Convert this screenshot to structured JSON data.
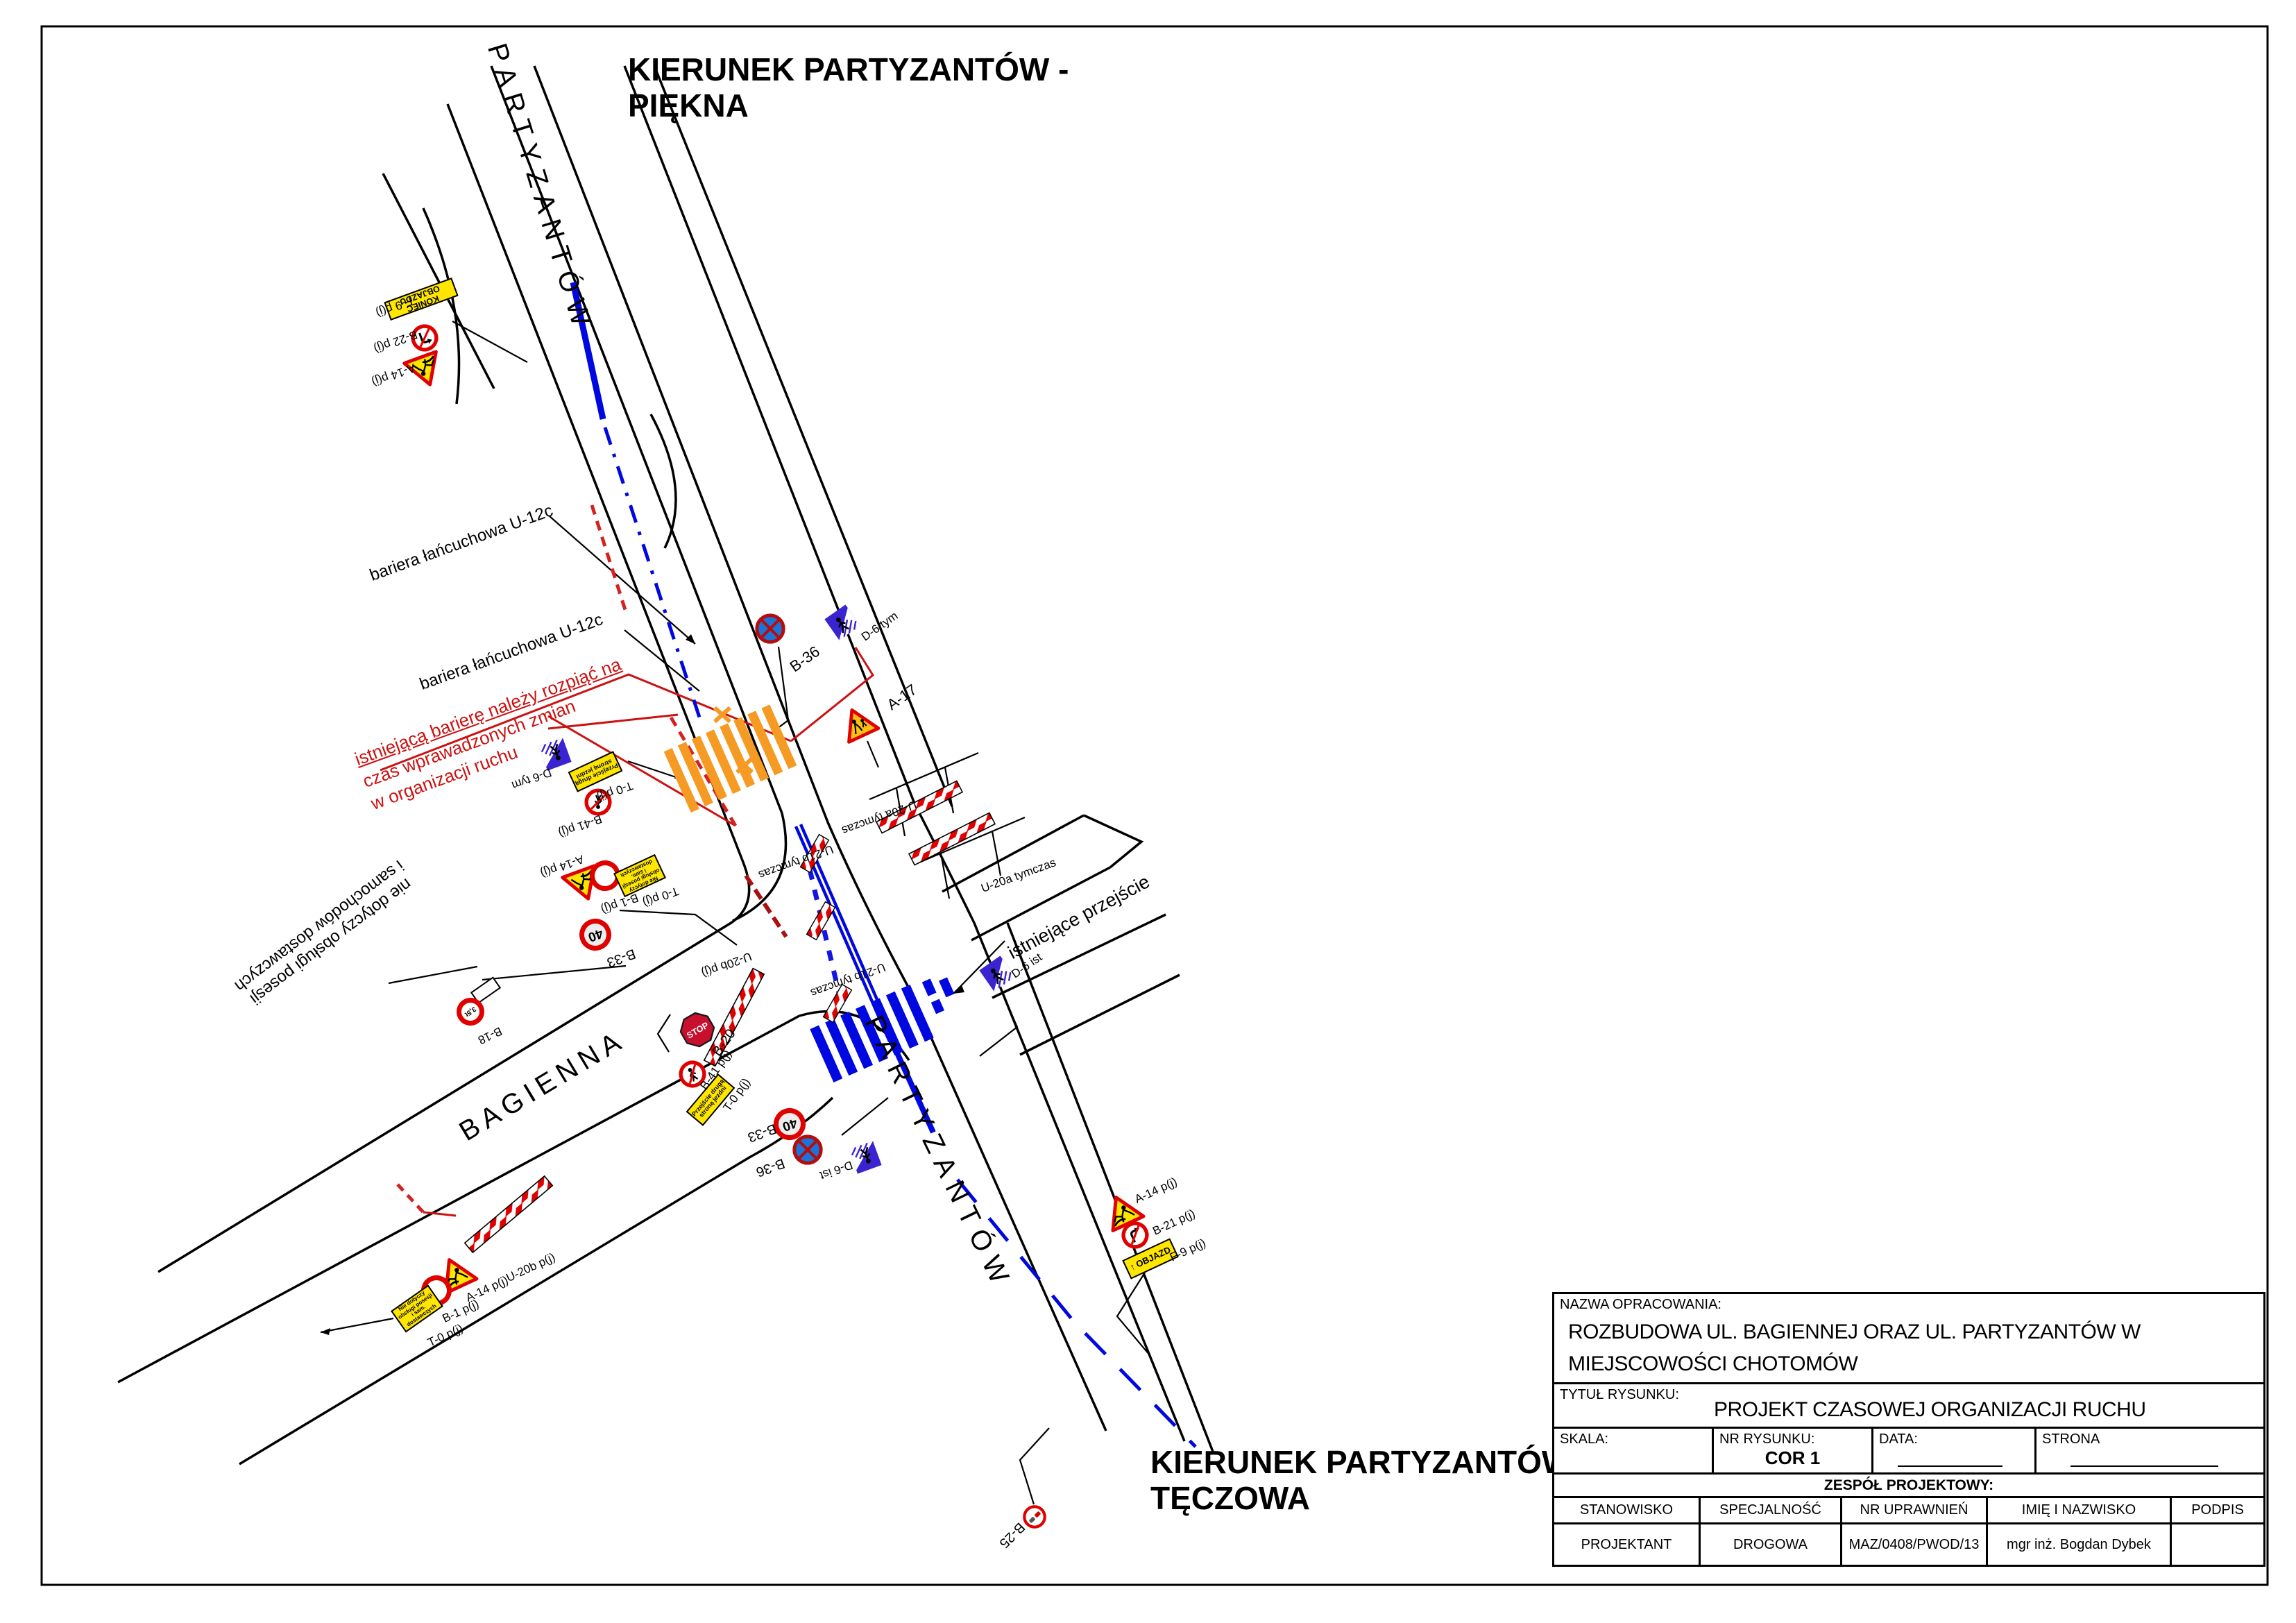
{
  "headings": {
    "top1": "KIERUNEK PARTYZANTÓW -",
    "top2": "PIĘKNA",
    "bottom1": "KIERUNEK PARTYZANTÓW -",
    "bottom2": "TĘCZOWA"
  },
  "streets": {
    "partyzantow": "PARTYZANTÓW",
    "bagienna": "BAGIENNA"
  },
  "notes": {
    "bariera": "bariera łańcuchowa U-12c",
    "red1": "istniejącą barierę należy rozpiąć na",
    "red2": "czas wprawadzonych zmian",
    "red3": "w organizacji ruchu",
    "nd1": "nie dotyczy obsługi posesji",
    "nd2": "i samochodów dostawczych",
    "existing_crossing": "istniejące przejście",
    "u20a": "U-20a tymczas",
    "u21b": "U-21b tymczas",
    "u20b": "U-20b p(j)"
  },
  "labels": {
    "f9": "F-9 p(j)",
    "b22": "B-22 p(j)",
    "a14": "A-14 p(j)",
    "b36": "B-36",
    "d6_tym": "D-6 tym",
    "d6_ist": "D-6 ist",
    "a17": "A-17",
    "t0": "T-0 p(j)",
    "b41": "B-41 p(j)",
    "b1": "B-1 p(j)",
    "b33": "B-33",
    "b20": "B-20",
    "b21": "B-21 p(j)",
    "b25": "B-25",
    "b18": "B-18"
  },
  "sign_text": {
    "stop": "STOP",
    "speed40": "40",
    "weight": "3,5t",
    "koniec_objazdu": "KONIEC OBJAZDU",
    "objazd": "OBJAZD",
    "arrow_up": "↑",
    "t_przejscie1": "Przejście drugą",
    "t_przejscie2": "stroną jezdni",
    "t_nd1": "Nie dotyczy",
    "t_nd2": "obsługi posesji",
    "t_nd3": "i sam. dostawczych"
  },
  "title_block": {
    "nazwa_label": "NAZWA OPRACOWANIA:",
    "nazwa1": "ROZBUDOWA UL. BAGIENNEJ ORAZ UL. PARTYZANTÓW W",
    "nazwa2": "MIEJSCOWOŚCI CHOTOMÓW",
    "tytul_label": "TYTUŁ RYSUNKU:",
    "tytul": "PROJEKT CZASOWEJ ORGANIZACJI RUCHU",
    "skala_label": "SKALA:",
    "nr_label": "NR RYSUNKU:",
    "nr_value": "COR 1",
    "data_label": "DATA:",
    "strona_label": "STRONA",
    "zespol": "ZESPÓŁ PROJEKTOWY:",
    "col_stanowisko": "STANOWISKO",
    "col_specjalnosc": "SPECJALNOŚĆ",
    "col_uprawnienia": "NR UPRAWNIEŃ",
    "col_imie": "IMIĘ I NAZWISKO",
    "col_podpis": "PODPIS",
    "row_stanowisko": "PROJEKTANT",
    "row_specjalnosc": "DROGOWA",
    "row_uprawnienia": "MAZ/0408/PWOD/13",
    "row_imie": "mgr inż. Bogdan Dybek",
    "row_podpis": ""
  },
  "colors": {
    "sign_red": "#e00000",
    "sign_yellow": "#ffe600",
    "d6_blue": "#3a23d0",
    "b36_blue": "#1b75d8",
    "marking_blue": "#0008e0",
    "marking_orange": "#f59a23",
    "note_red": "#cc1111"
  }
}
